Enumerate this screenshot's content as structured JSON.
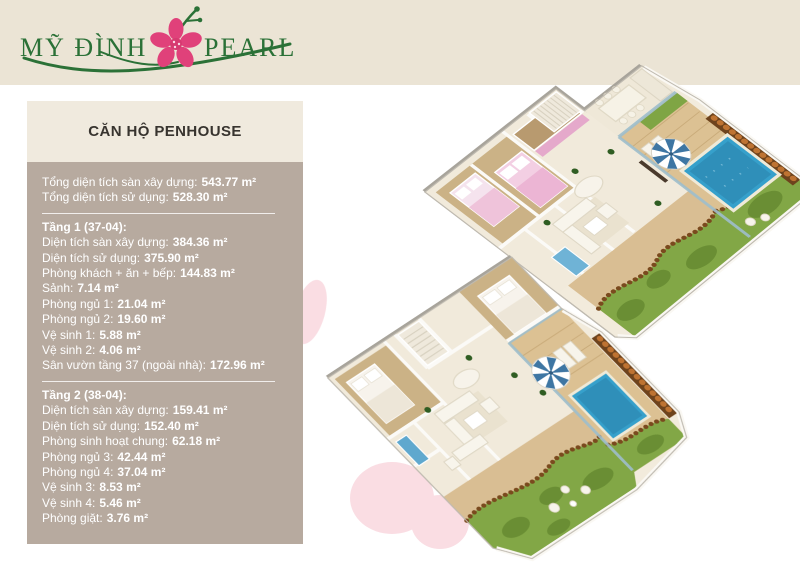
{
  "brand": {
    "name_first": "MỸ ĐÌNH",
    "name_second": "PEARL",
    "flower_icon": "pink-apricot-blossom",
    "text_color": "#2B7137",
    "flower_color": "#E0417A"
  },
  "panel": {
    "title": "CĂN HỘ PENHOUSE",
    "summary": [
      {
        "label": "Tổng diện tích sàn xây dựng:",
        "value": "543.77 m²"
      },
      {
        "label": "Tổng diện tích sử dụng:",
        "value": "528.30 m²"
      }
    ],
    "sections": [
      {
        "header": "Tầng 1 (37-04):",
        "lines": [
          {
            "label": "Diện tích sàn xây dựng:",
            "value": "384.36 m²"
          },
          {
            "label": "Diện tích sử dụng:",
            "value": "375.90 m²"
          },
          {
            "label": "Phòng khách + ăn + bếp:",
            "value": "144.83 m²"
          },
          {
            "label": "Sảnh:",
            "value": "7.14 m²"
          },
          {
            "label": "Phòng ngủ 1:",
            "value": "21.04 m²"
          },
          {
            "label": "Phòng ngủ 2:",
            "value": "19.60 m²"
          },
          {
            "label": "Vệ sinh 1:",
            "value": "5.88 m²"
          },
          {
            "label": "Vệ sinh 2:",
            "value": "4.06 m²"
          },
          {
            "label": "Sân vườn tầng 37 (ngoài nhà):",
            "value": "172.96 m²"
          }
        ]
      },
      {
        "header": "Tầng 2 (38-04):",
        "lines": [
          {
            "label": "Diện tích sàn xây dựng:",
            "value": "159.41 m²"
          },
          {
            "label": "Diện tích sử dụng:",
            "value": "152.40 m²"
          },
          {
            "label": "Phòng sinh hoạt chung:",
            "value": "62.18 m²"
          },
          {
            "label": "Phòng ngủ 3:",
            "value": "42.44 m²"
          },
          {
            "label": "Phòng ngủ 4:",
            "value": "37.04 m²"
          },
          {
            "label": "Vệ sinh 3:",
            "value": "8.53 m²"
          },
          {
            "label": "Vệ sinh 4:",
            "value": "5.46 m²"
          },
          {
            "label": "Phòng giặt:",
            "value": "3.76 m²"
          }
        ]
      }
    ]
  },
  "colors": {
    "header_band": "#EBE4D5",
    "panel_title_bg": "#F0EADE",
    "panel_body_bg": "#B7AA9F",
    "panel_text": "#FFFFFF",
    "floor_cream": "#F1EADB",
    "deck_wood": "#DCC193",
    "pool_blue": "#36A0CB",
    "garden_green": "#82A746",
    "mulch_brown": "#6E431C",
    "petal_pink": "#F8D2DA"
  }
}
